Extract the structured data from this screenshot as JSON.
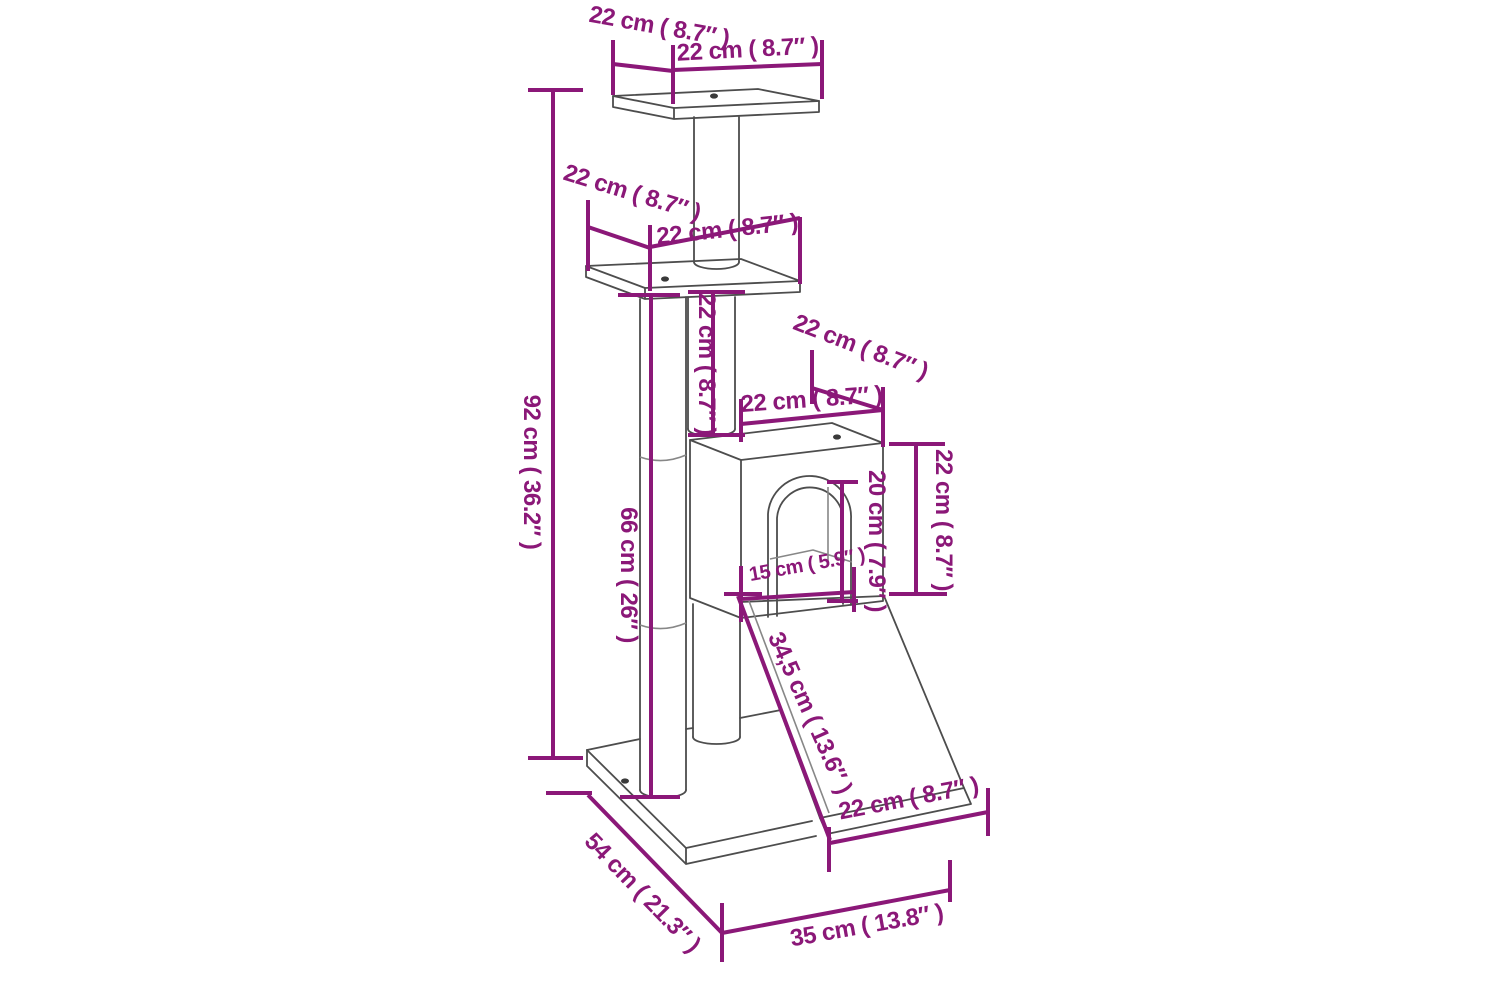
{
  "diagram": {
    "kind": "product-dimension-diagram",
    "subject": "cat scratching tree with platforms, house and ramp",
    "background_color": "#ffffff",
    "line_color": "#4d4d4d",
    "dimension_color": "#8B1878",
    "dimensions": {
      "top_platform_depth": "22 cm ( 8.7″ )",
      "top_platform_width": "22 cm ( 8.7″ )",
      "mid_platform_depth": "22 cm ( 8.7″ )",
      "mid_platform_width": "22 cm ( 8.7″ )",
      "total_height": "92 cm ( 36.2″ )",
      "post_height": "66 cm ( 26″ )",
      "column_segment_height": "22 cm ( 8.7″ )",
      "house_top_depth": "22 cm ( 8.7″ )",
      "house_top_width": "22 cm ( 8.7″ )",
      "house_height": "22 cm ( 8.7″ )",
      "door_height": "20 cm ( 7.9″ )",
      "door_shelf_width": "15 cm ( 5.9″ )",
      "ramp_length": "34,5 cm ( 13.6″ )",
      "ramp_width": "22 cm ( 8.7″ )",
      "base_depth": "54 cm ( 21.3″ )",
      "base_width": "35 cm ( 13.8″ )"
    }
  }
}
